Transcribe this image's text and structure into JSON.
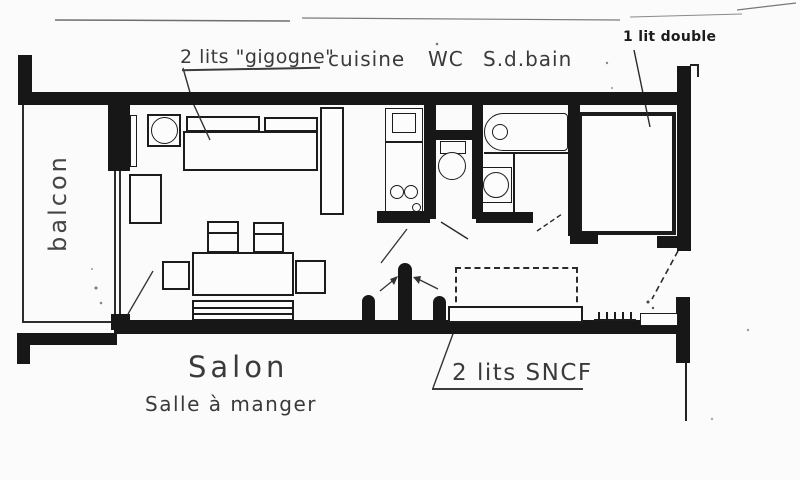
{
  "labels": {
    "gigogne": "2 lits \"gigogne\"",
    "cuisine": "cuisine",
    "wc": "WC",
    "sdbain": "S.d.bain",
    "lit_double": "1 lit double",
    "balcon": "balcon",
    "salon": "Salon",
    "salle_a_manger": "Salle à manger",
    "lits_sncf": "2 lits SNCF"
  },
  "colors": {
    "ink": "#171717",
    "paper": "#fbfbfb",
    "annotation": "#3a3a3a"
  }
}
